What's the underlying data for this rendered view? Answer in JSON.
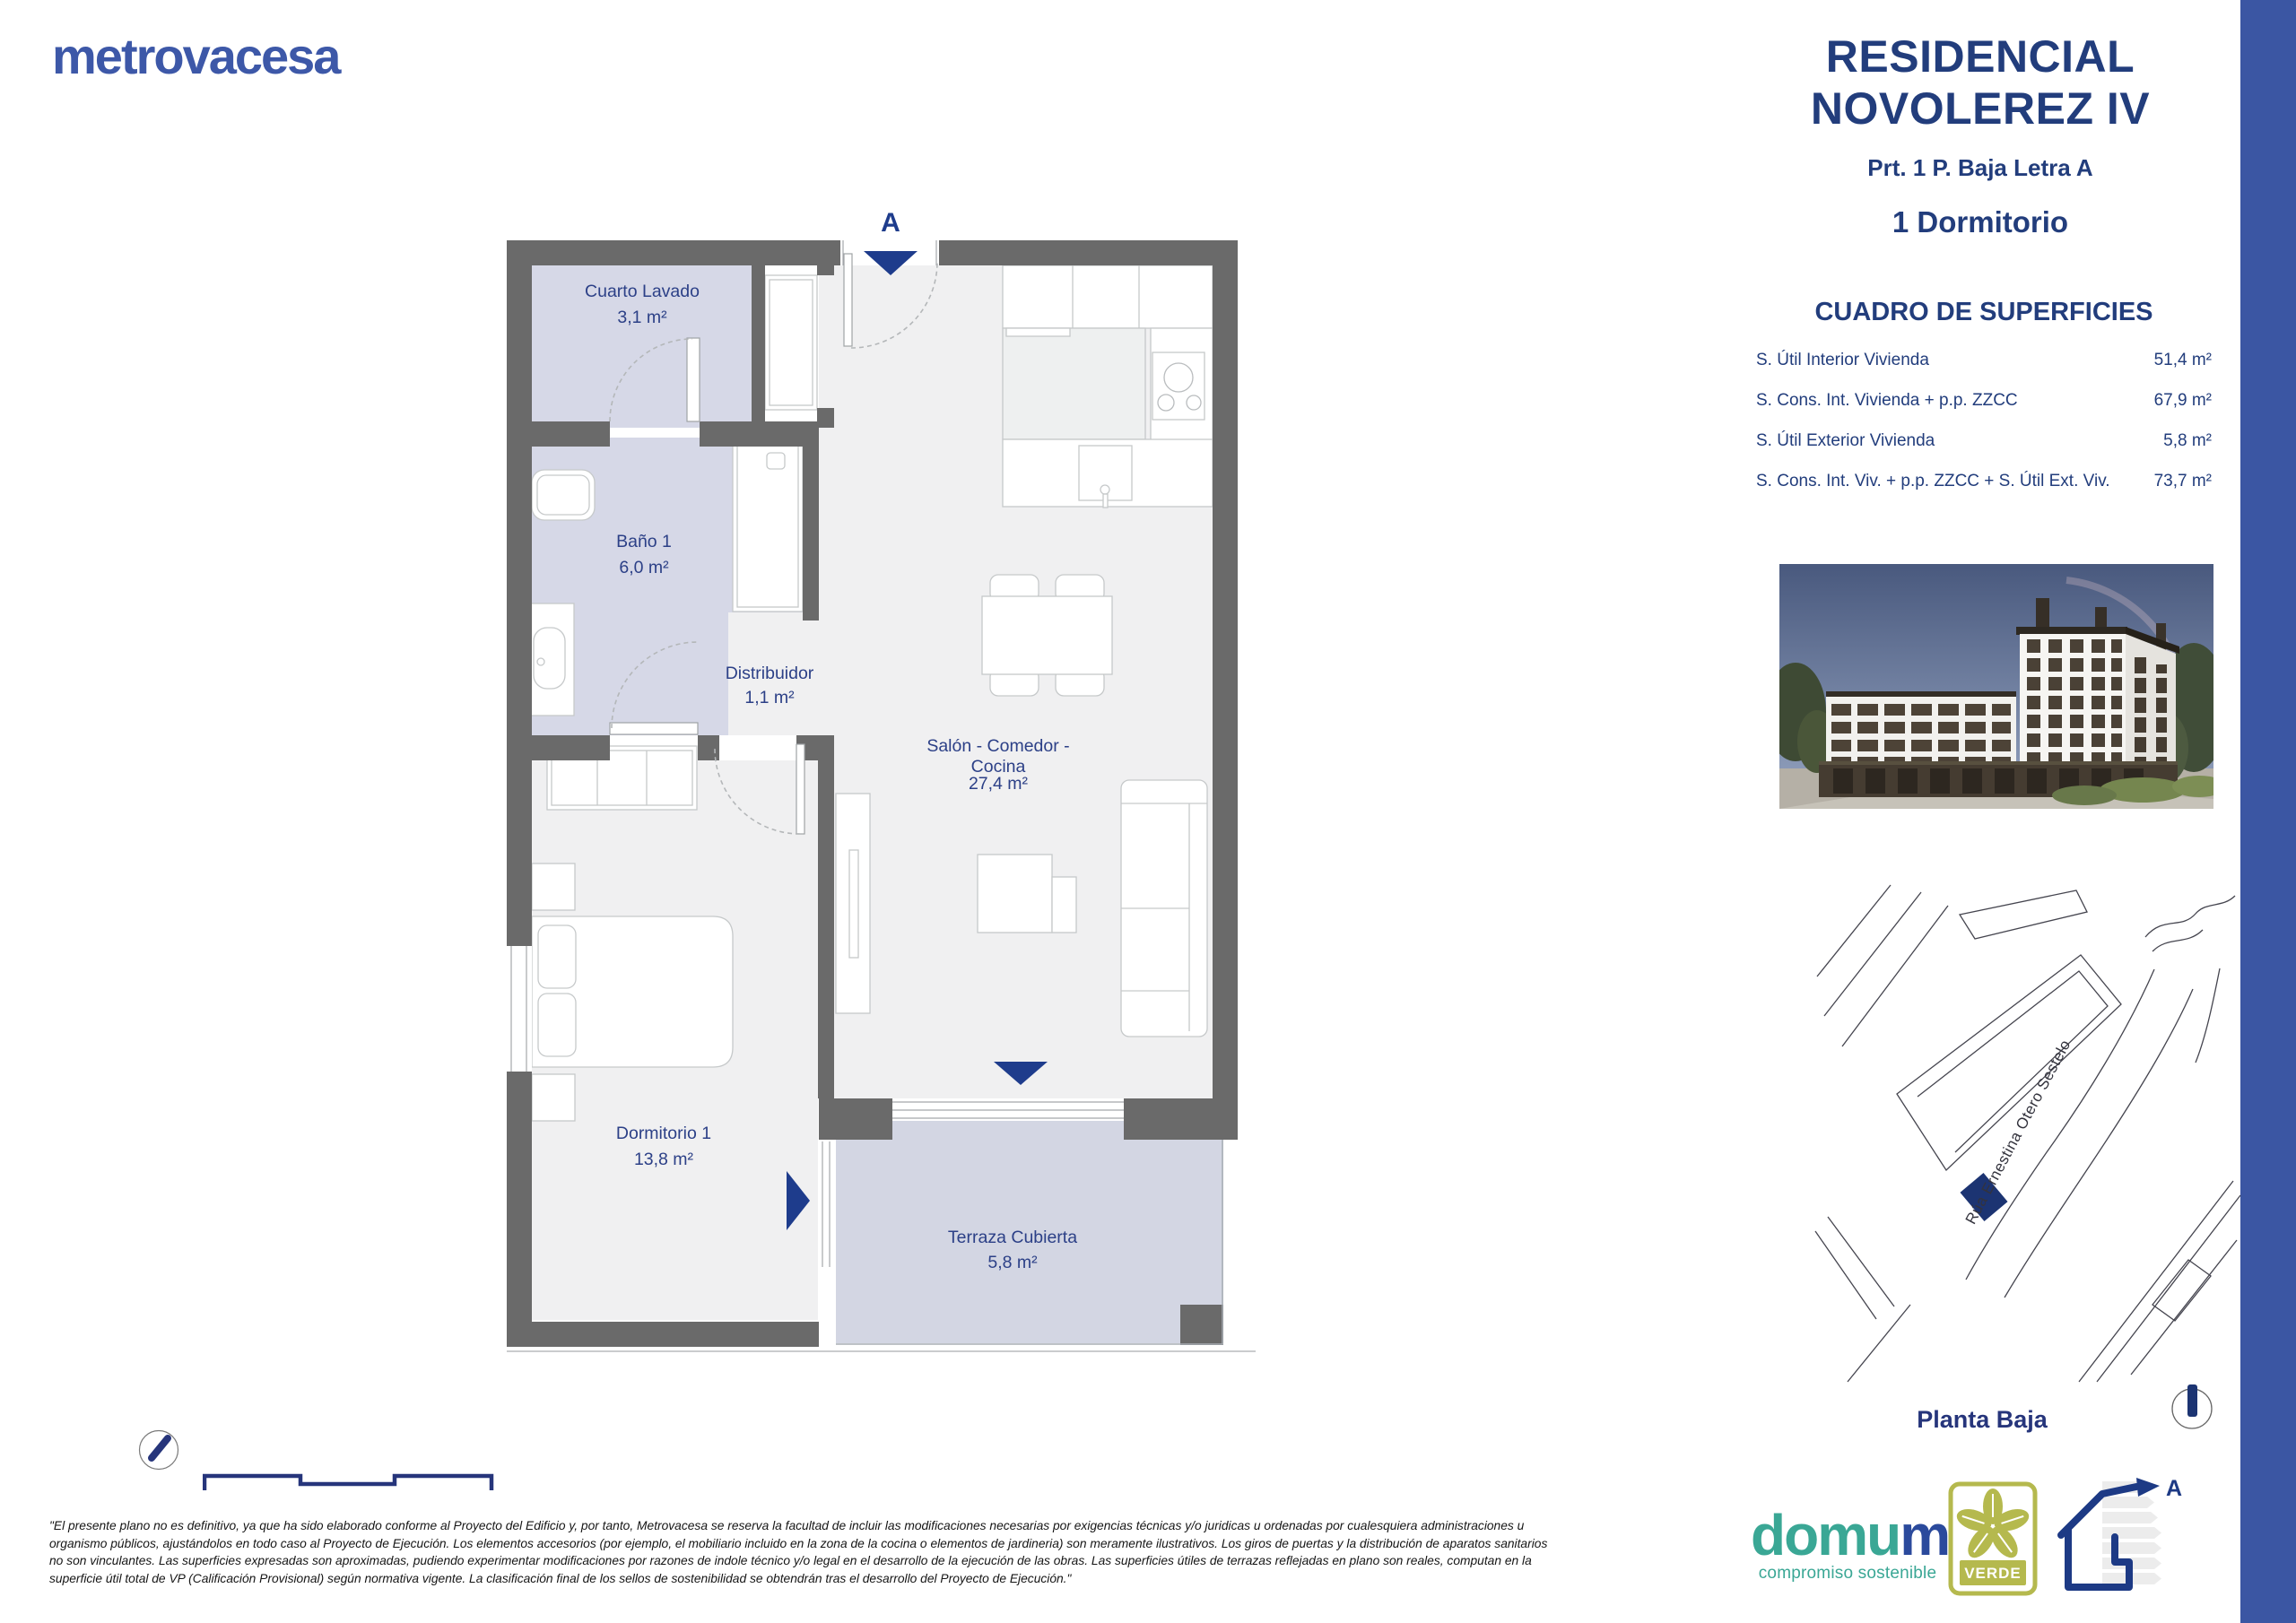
{
  "brand": {
    "logo": "metrovacesa"
  },
  "header": {
    "title_line1": "RESIDENCIAL",
    "title_line2": "NOVOLEREZ IV",
    "unit": "Prt. 1 P. Baja Letra A",
    "typology": "1 Dormitorio"
  },
  "surfaces": {
    "title": "CUADRO DE SUPERFICIES",
    "rows": [
      {
        "label": "S. Útil Interior Vivienda",
        "value": "51,4 m²"
      },
      {
        "label": "S. Cons. Int. Vivienda + p.p. ZZCC",
        "value": "67,9 m²"
      },
      {
        "label": "S. Útil Exterior Vivienda",
        "value": "5,8 m²"
      },
      {
        "label": "S. Cons. Int. Viv. + p.p. ZZCC + S. Útil Ext. Viv.",
        "value": "73,7 m²"
      }
    ]
  },
  "plan": {
    "entrance_label": "A",
    "rooms": [
      {
        "name": "Cuarto Lavado",
        "area": "3,1 m²"
      },
      {
        "name": "Baño 1",
        "area": "6,0 m²"
      },
      {
        "name": "Distribuidor",
        "area": "1,1 m²"
      },
      {
        "name": "Salón - Comedor -",
        "name2": "Cocina",
        "area": "27,4 m²"
      },
      {
        "name": "Dormitorio 1",
        "area": "13,8 m²"
      },
      {
        "name": "Terraza Cubierta",
        "area": "5,8 m²"
      }
    ]
  },
  "map": {
    "street": "Rúa Ernestina Otero Sestelo",
    "floor_label": "Planta Baja"
  },
  "footer": {
    "disclaimer_lines": [
      "\"El presente plano no es definitivo, ya que ha sido elaborado conforme al Proyecto del Edificio y, por tanto, Metrovacesa se reserva la facultad de incluir las modificaciones necesarias por exigencias técnicas y/o juridicas u ordenadas por cualesquiera administraciones u",
      "organismo públicos, ajustándolos en todo caso al Proyecto de Ejecución. Los elementos accesorios (por ejemplo, el mobiliario incluido en la zona de la cocina o elementos de jardineria) son meramente ilustrativos. Los giros de puertas y la distribución de aparatos sanitarios",
      "no son vinculantes. Las superficies expresadas son aproximadas, pudiendo experimentar modificaciones por razones de indole técnico y/o legal en el desarrollo de la ejecución de las obras. Las superficies útiles de terrazas reflejadas en plano son reales, computan en la",
      "superficie útil total de VP (Calificación Provisional) según normativa vigente. La clasificación final de los sellos de sostenibilidad se obtendrán tras el desarrollo del Proyecto de Ejecución.\""
    ],
    "domum": {
      "part1": "domu",
      "part2": "m",
      "tagline": "compromiso sostenible"
    },
    "verde_label": "VERDE",
    "energy_label": "A"
  },
  "colors": {
    "brand_blue": "#3d58a8",
    "header_navy": "#223d7c",
    "accent_navy": "#1e3c8c",
    "side_bar_blue": "#3b56a3",
    "wall_gray": "#6a6a6a",
    "room_lavender": "#d6d8e7",
    "terrace_lavender": "#d3d6e3",
    "floor_gray": "#f0f0f1",
    "domum_teal": "#3aa795",
    "verde_olive": "#b5b94e"
  }
}
